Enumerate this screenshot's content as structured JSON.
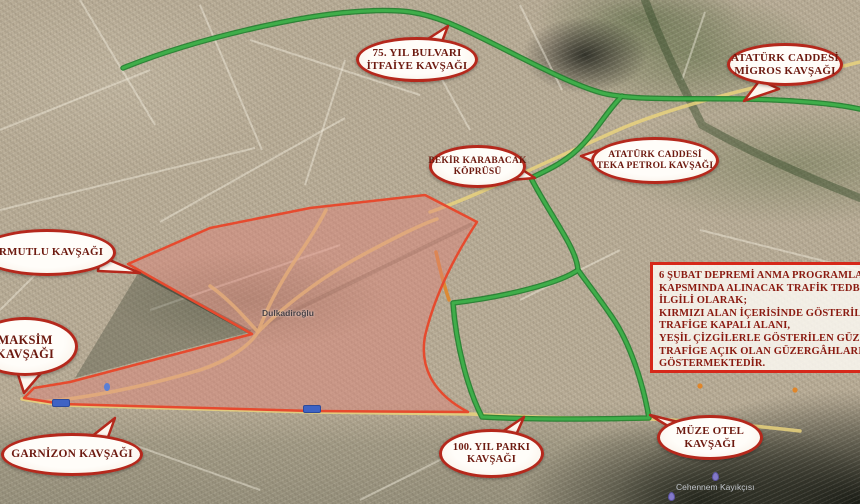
{
  "map": {
    "callouts": [
      {
        "id": "75yil",
        "lines": [
          "75. YIL BULVARI",
          "İTFAİYE KAVŞAĞI"
        ]
      },
      {
        "id": "migros",
        "lines": [
          "ATATÜRK CADDESİ",
          "MİGROS KAVŞAĞI"
        ]
      },
      {
        "id": "bekir",
        "lines": [
          "BEKİR KARABACAK",
          "KÖPRÜSÜ"
        ]
      },
      {
        "id": "teka",
        "lines": [
          "ATATÜRK CADDESİ",
          "TEKA PETROL KAVŞAĞI"
        ]
      },
      {
        "id": "armutlu",
        "lines": [
          "ARMUTLU KAVŞAĞI"
        ]
      },
      {
        "id": "maksim",
        "lines": [
          "MAKSİM",
          "KAVŞAĞI"
        ]
      },
      {
        "id": "garnizon",
        "lines": [
          "GARNİZON KAVŞAĞI"
        ]
      },
      {
        "id": "100yil",
        "lines": [
          "100. YIL PARKI",
          "KAVŞAĞI"
        ]
      },
      {
        "id": "muze",
        "lines": [
          "MÜZE OTEL",
          "KAVŞAĞI"
        ]
      }
    ],
    "info_box": {
      "lines": [
        "6 ŞUBAT DEPREMİ ANMA PROGRAMLARI",
        "KAPSMINDA ALINACAK TRAFİK TEDBİRLERİ İLE",
        "İLGİLİ OLARAK;",
        "KIRMIZI ALAN İÇERİSİNDE GÖSTERİLEN BÖLGE",
        "TRAFİGE KAPALI ALANI,",
        "YEŞİL ÇİZGİLERLE GÖSTERİLEN GÜZERGÂHLARI",
        "TRAFİGE AÇIK OLAN GÜZERGÂHLARI",
        "GÖSTERMEKTEDİR."
      ]
    },
    "map_labels": {
      "district": "Dulkadiroğlu",
      "landmark": "Cehennem Kayıkçısı"
    },
    "legend_semantics": {
      "green_lines": "trafiğe açık güzergâhlar",
      "red_area": "trafiğe kapalı alan"
    },
    "colors": {
      "open_route": "#3fae4a",
      "open_route_edge": "#1f7f2c",
      "closed_fill": "#de8277",
      "closed_border": "#e64a2e",
      "callout_border": "#b5281c",
      "callout_text": "#6d1a10",
      "info_text": "#8a1a10",
      "road_yellow": "#e9d27c"
    }
  }
}
